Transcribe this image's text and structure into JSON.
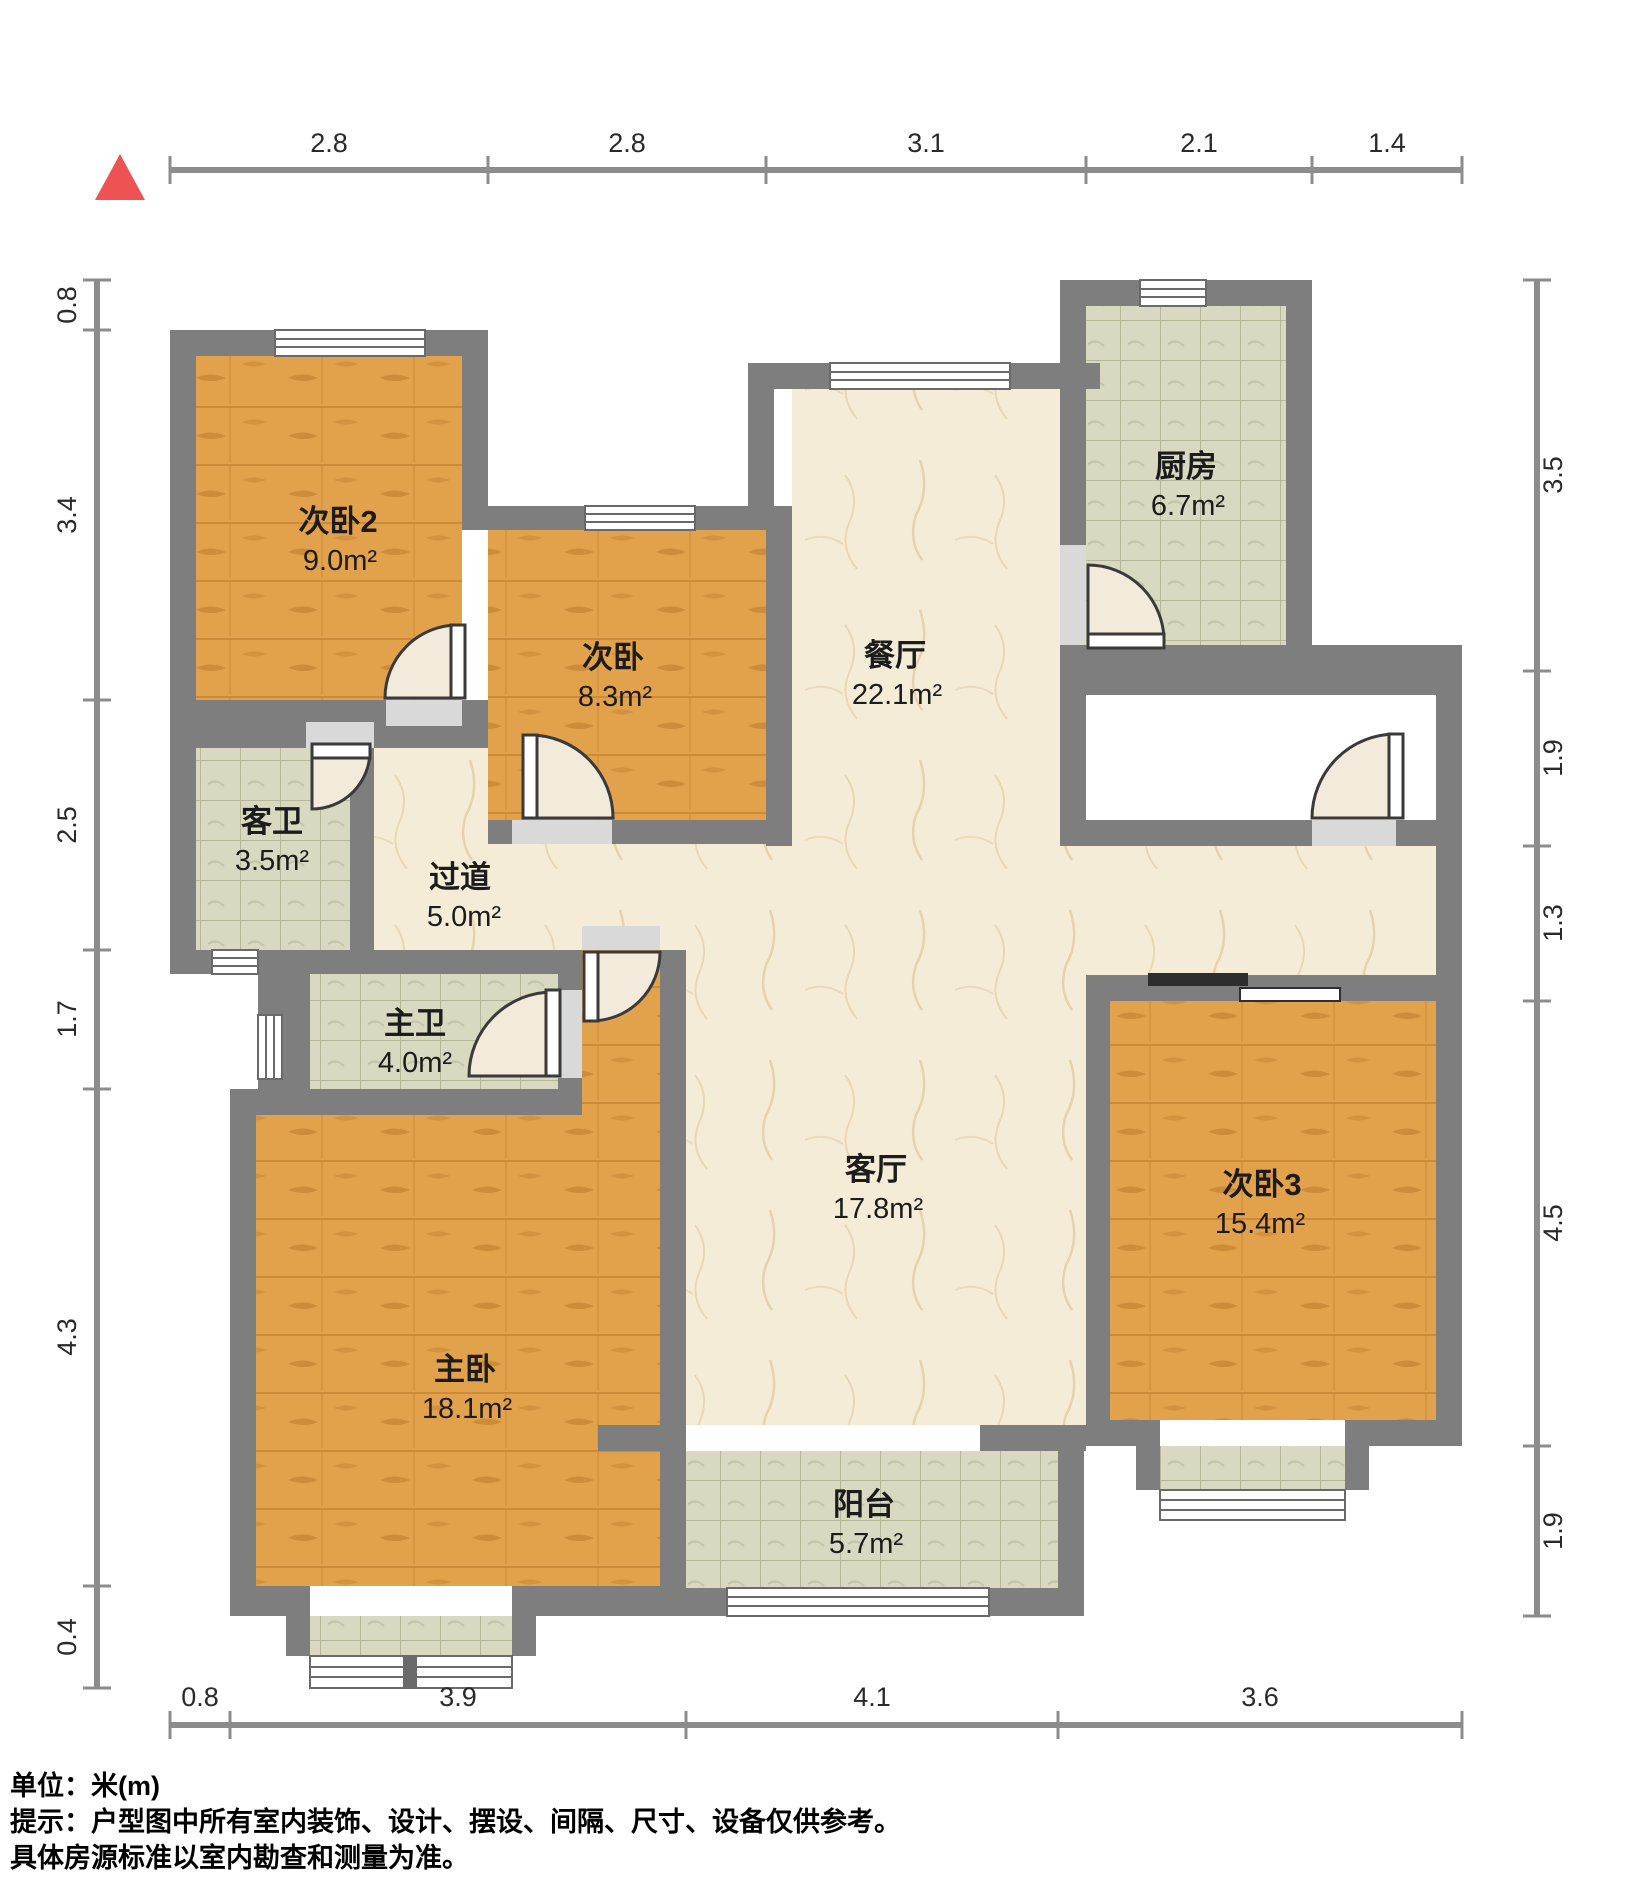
{
  "north_marker": {
    "icon": "red-triangle",
    "color": "#ee5253"
  },
  "rooms": [
    {
      "id": "bedroom2",
      "name": "次卧2",
      "area": "9.0m²"
    },
    {
      "id": "bedroom",
      "name": "次卧",
      "area": "8.3m²"
    },
    {
      "id": "dining-room",
      "name": "餐厅",
      "area": "22.1m²"
    },
    {
      "id": "kitchen",
      "name": "厨房",
      "area": "6.7m²"
    },
    {
      "id": "guest-bathroom",
      "name": "客卫",
      "area": "3.5m²"
    },
    {
      "id": "hallway",
      "name": "过道",
      "area": "5.0m²"
    },
    {
      "id": "master-bathroom",
      "name": "主卫",
      "area": "4.0m²"
    },
    {
      "id": "living-room",
      "name": "客厅",
      "area": "17.8m²"
    },
    {
      "id": "bedroom3",
      "name": "次卧3",
      "area": "15.4m²"
    },
    {
      "id": "master-bedroom",
      "name": "主卧",
      "area": "18.1m²"
    },
    {
      "id": "balcony",
      "name": "阳台",
      "area": "5.7m²"
    }
  ],
  "dimensions": {
    "top": [
      "2.8",
      "2.8",
      "3.1",
      "2.1",
      "1.4"
    ],
    "bottom": [
      "0.8",
      "3.9",
      "4.1",
      "3.6"
    ],
    "left": [
      "0.8",
      "3.4",
      "2.5",
      "1.7",
      "4.3",
      "0.4"
    ],
    "right": [
      "3.5",
      "1.9",
      "1.3",
      "4.5",
      "1.9"
    ]
  },
  "notes": {
    "unit": "单位：米(m)",
    "tip1": "提示：户型图中所有室内装饰、设计、摆设、间隔、尺寸、设备仅供参考。",
    "tip2": "具体房源标准以室内勘查和测量为准。"
  },
  "colors": {
    "wall": "#7e7e7e",
    "wood_floor": "#e2a14b",
    "tile_floor": "#d9d8c0",
    "stone_floor": "#f5ecd8",
    "north_red": "#ee5253"
  }
}
